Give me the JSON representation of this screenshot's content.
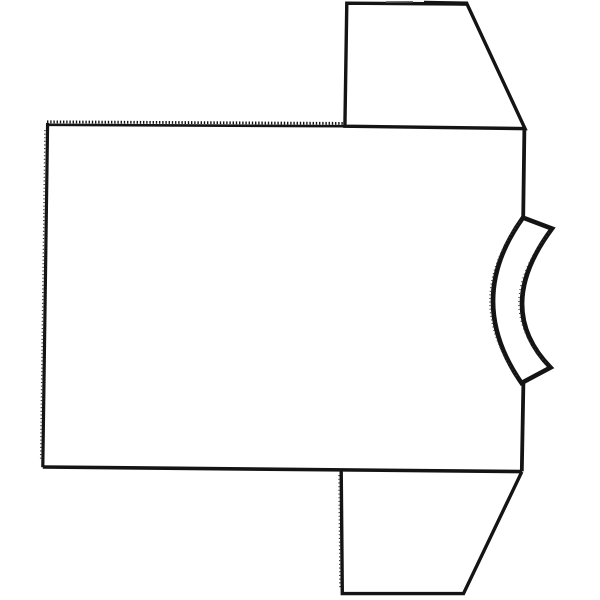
{
  "figure": {
    "description": "Black-and-white line drawing of a T-shirt pattern laid flat, rotated 90 degrees: large rectangular body panel on the left, two trapezoidal sleeves on the upper-right and lower-right, and a curved crescent neckband piece on the middle-right. Top edge of the body and left edge carry a fine serrated / stitched texture.",
    "background_color": "#ffffff",
    "stroke_color": "#141414",
    "stipple_color": "#3a3a3a"
  },
  "drawing": {
    "width": 600,
    "height": 600,
    "shapes": [
      {
        "name": "body-top-edge",
        "d": "M48,124.8 L345,126.2",
        "width": 2.6
      },
      {
        "name": "body-top-edge-serration",
        "d": "M47,121.8 L345,123.4",
        "width": 2.8,
        "dash": "1.4 1.8"
      },
      {
        "name": "body-left-edge",
        "d": "M47.6,123 L42.8,467.2",
        "width": 3.2
      },
      {
        "name": "body-left-edge-stipple",
        "d": "M44.9,130 L40.6,461",
        "width": 1.4,
        "dash": "1.1 2.5",
        "stroke": "#3a3a3a"
      },
      {
        "name": "body-bottom-edge",
        "d": "M42.8,467 L522,471.6",
        "width": 3.6
      },
      {
        "name": "body-right-edge-upper",
        "d": "M524.4,128 L523.2,216.8",
        "width": 3.8
      },
      {
        "name": "body-right-edge-lower",
        "d": "M523.4,382.8 L521.8,471.4",
        "width": 3.8
      },
      {
        "name": "top-sleeve-outline",
        "d": "M346.8,3.2 L467,4 L525,128.6 L344.9,126.2 Z",
        "width": 3.4
      },
      {
        "name": "top-sleeve-edge-rough-a",
        "d": "M386,1.9 L413,1.7",
        "width": 1.5,
        "stroke": "#6a6a6a"
      },
      {
        "name": "top-sleeve-edge-rough-b",
        "d": "M424,2.8 L468,3.6",
        "width": 4.2
      },
      {
        "name": "bottom-sleeve-outline",
        "d": "M341.2,470.6 L342.3,593.6 L463.5,593.6 L521.8,471.8",
        "width": 3.4
      },
      {
        "name": "bottom-sleeve-left-stipple",
        "d": "M338.9,475 L339.9,589",
        "width": 1.3,
        "dash": "1.1 2.6",
        "stroke": "#3a3a3a"
      },
      {
        "name": "collar-band",
        "d": "M523,217.6 L552,228.6 Q492.8,308 550.5,367.5 L521.5,383 Q463.8,299.8 523,217.6 Z",
        "width": 4.6
      },
      {
        "name": "collar-outer-stipple",
        "d": "M519.5,222 Q461,300 518,378",
        "width": 1.3,
        "dash": "1 2.6",
        "stroke": "#3a3a3a"
      },
      {
        "name": "collar-inner-stipple",
        "d": "M548.8,232.5 Q489.8,306 547,363.5",
        "width": 1.2,
        "dash": "1 3",
        "stroke": "#3a3a3a"
      }
    ]
  }
}
